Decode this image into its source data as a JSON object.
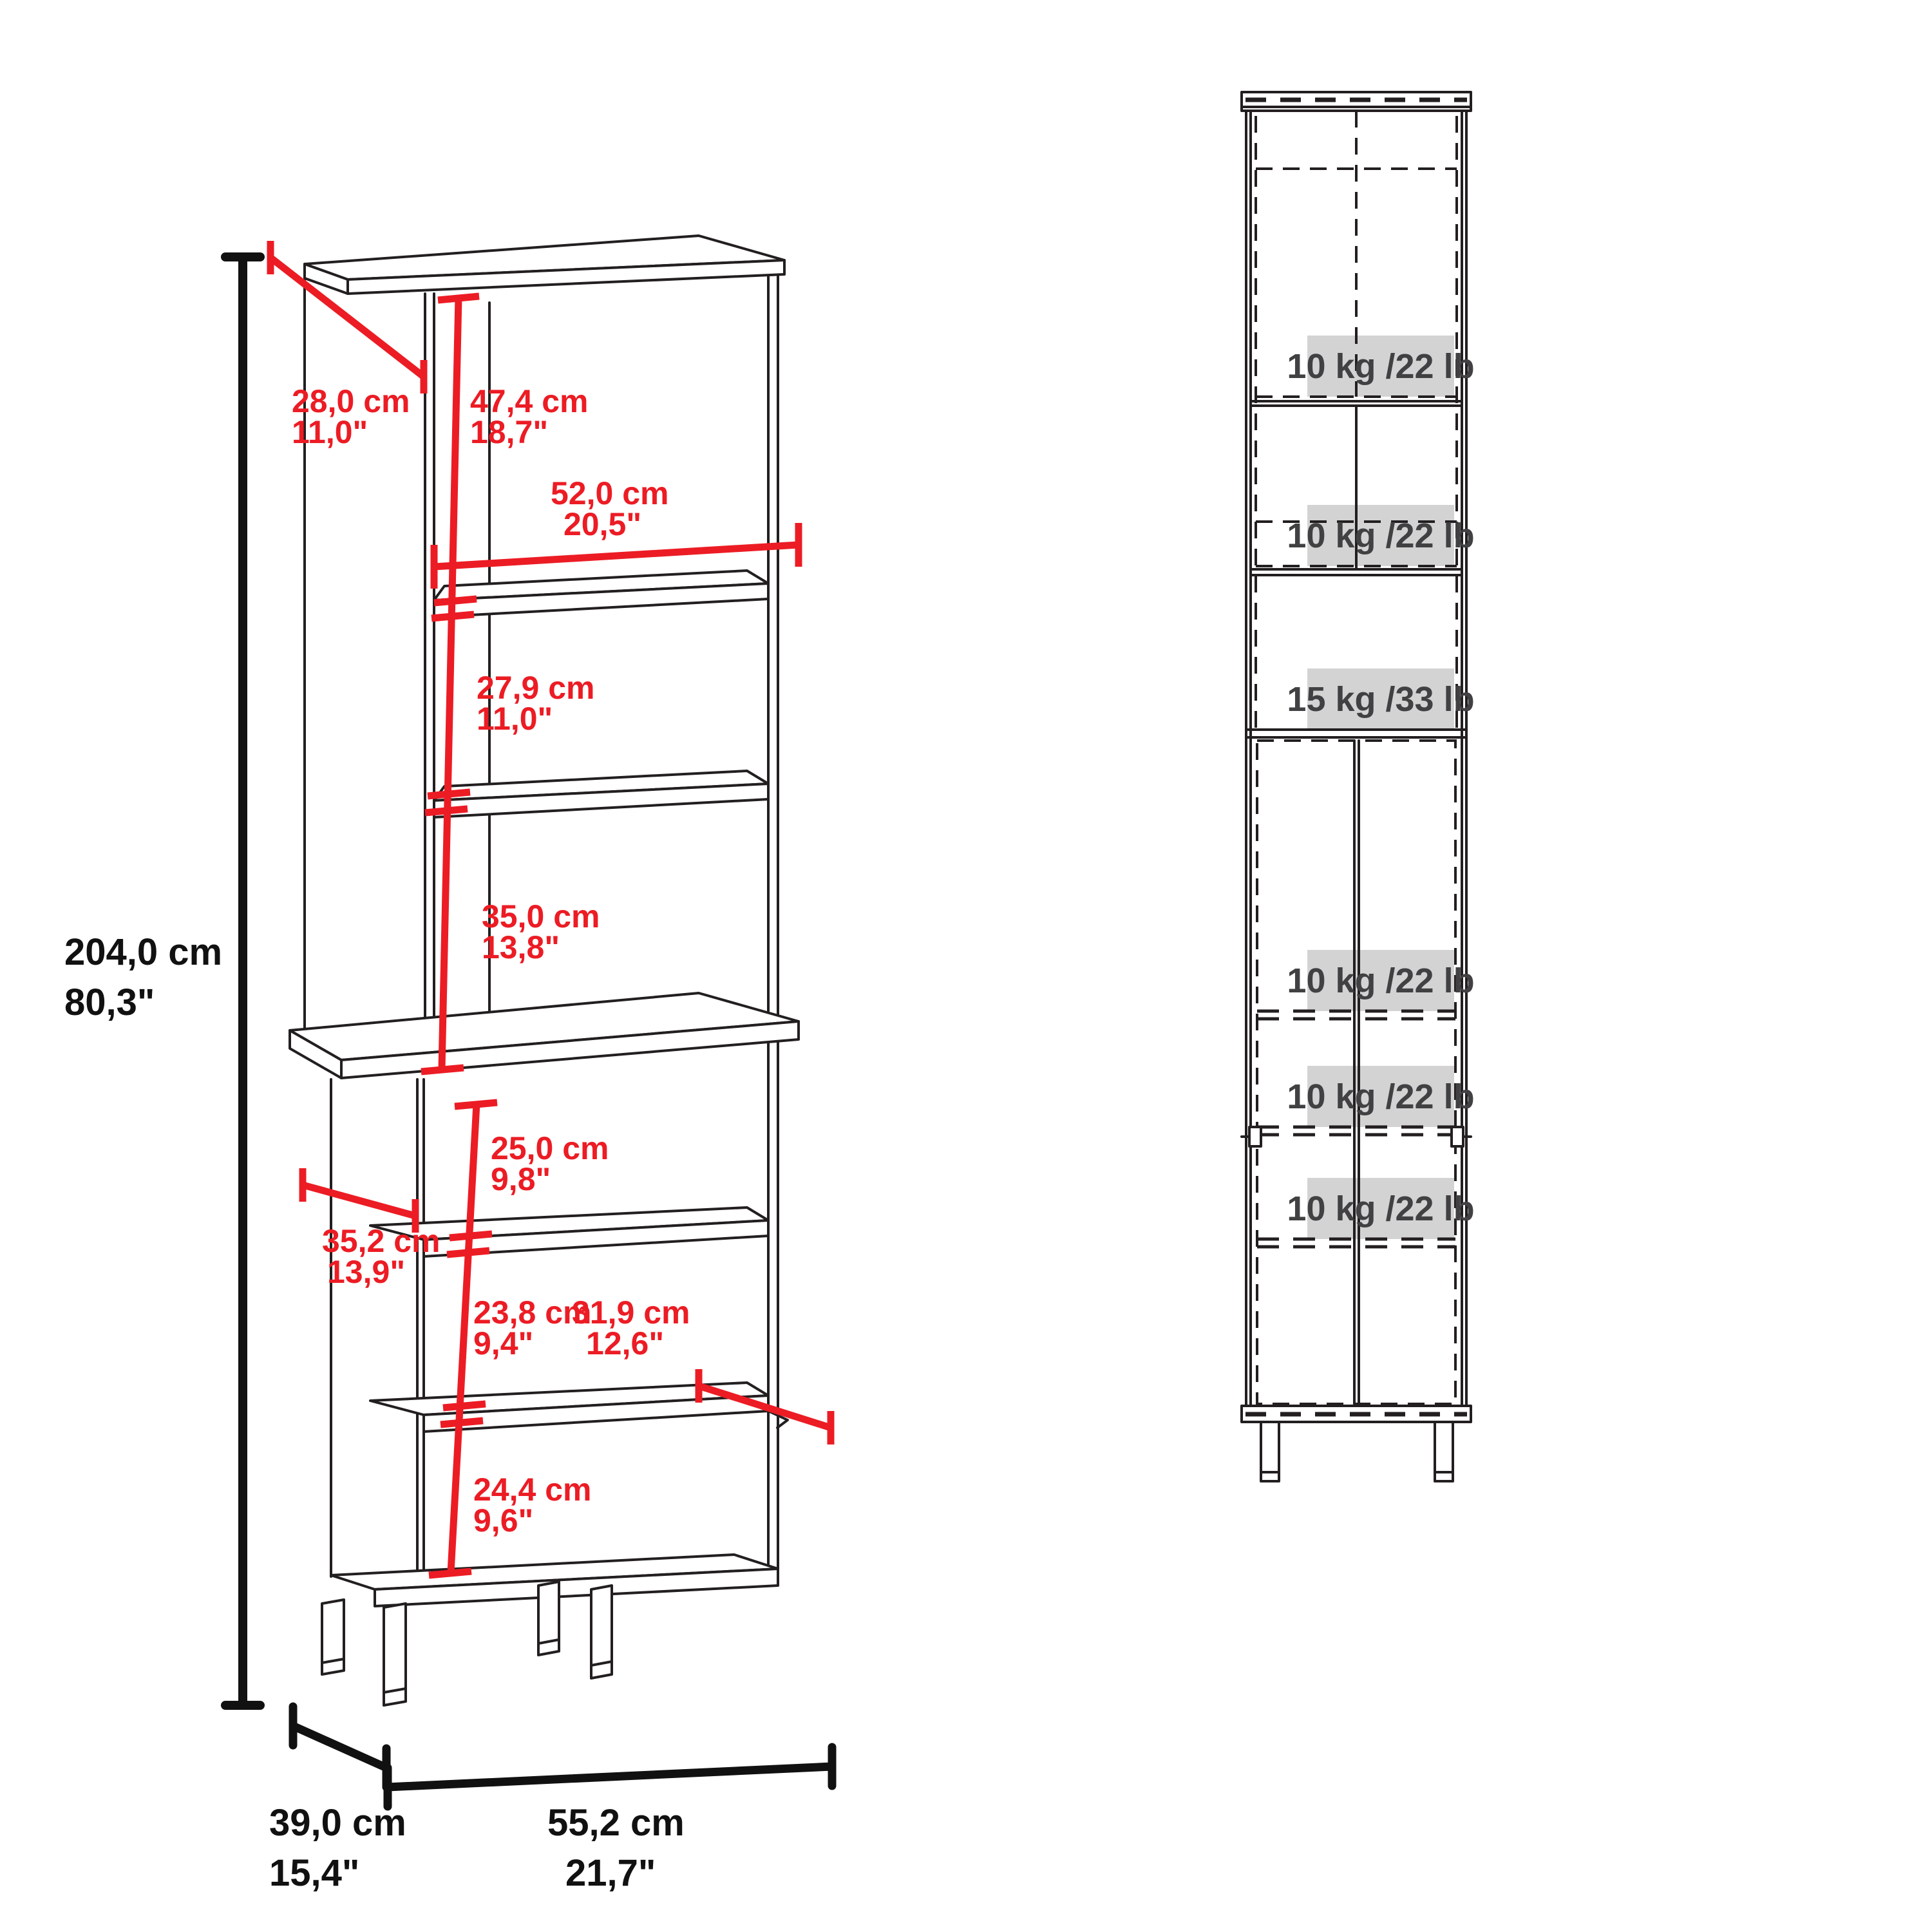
{
  "left_view": {
    "overall_height": {
      "cm": "204,0 cm",
      "in": "80,3\""
    },
    "top_depth": {
      "cm": "28,0 cm",
      "in": "11,0\""
    },
    "hutch_top_section": {
      "cm": "47,4 cm",
      "in": "18,7\""
    },
    "interior_width": {
      "cm": "52,0 cm",
      "in": "20,5\""
    },
    "hutch_mid_section": {
      "cm": "27,9 cm",
      "in": "11,0\""
    },
    "hutch_bottom_section": {
      "cm": "35,0 cm",
      "in": "13,8\""
    },
    "base_top_section": {
      "cm": "25,0 cm",
      "in": "9,8\""
    },
    "base_depth": {
      "cm": "35,2 cm",
      "in": "13,9\""
    },
    "base_mid_section": {
      "cm": "23,8 cm",
      "in": "9,4\""
    },
    "shelf_depth": {
      "cm": "31,9 cm",
      "in": "12,6\""
    },
    "base_bottom_section": {
      "cm": "24,4 cm",
      "in": "9,6\""
    },
    "bottom_depth": {
      "cm": "39,0 cm",
      "in": "15,4\""
    },
    "bottom_width": {
      "cm": "55,2 cm",
      "in": "21,7\""
    }
  },
  "right_view": {
    "shelf_capacities": [
      "10 kg /22 lb",
      "10 kg /22 lb",
      "15 kg /33 lb",
      "10 kg /22 lb",
      "10 kg /22 lb",
      "10 kg /22 lb"
    ]
  },
  "colors": {
    "dimension_red": "#ec1c24",
    "line_black": "#231f20",
    "capacity_box_gray": "#d3d3d3",
    "capacity_text_gray": "#414042"
  }
}
